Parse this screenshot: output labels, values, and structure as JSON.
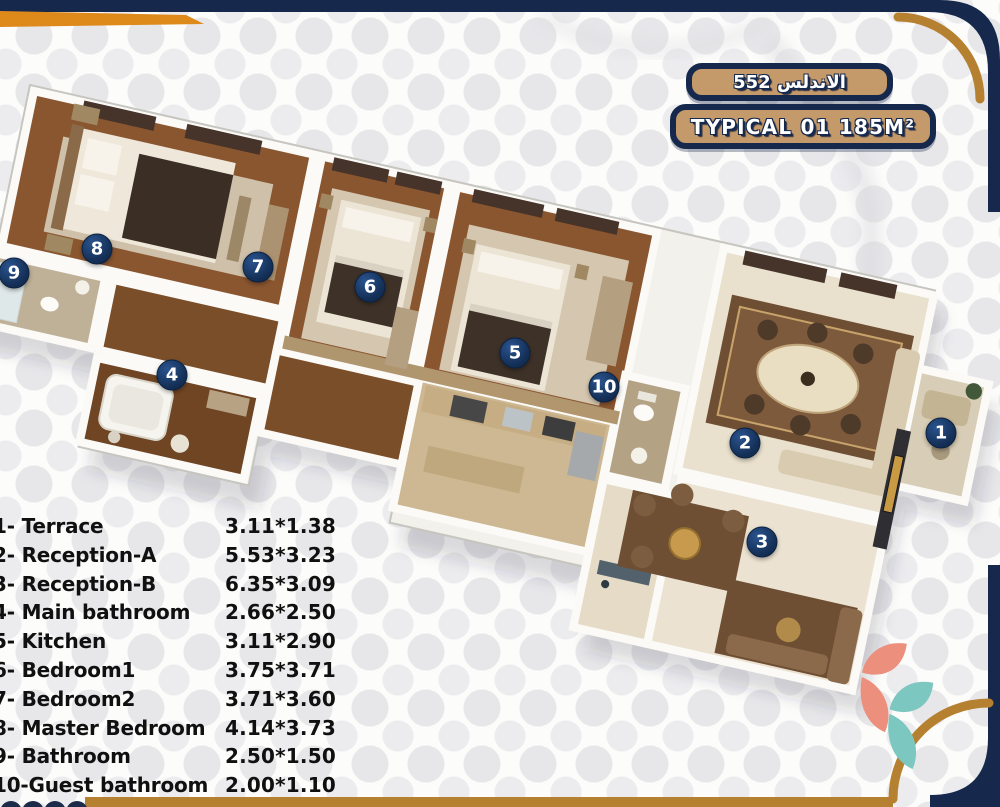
{
  "title_badges": {
    "project": "الاندلس 552",
    "unit_type": "TYPICAL 01 185M²"
  },
  "colors": {
    "navy": "#16294d",
    "gold": "#b5802f",
    "orange": "#dd8a1b",
    "badge_tan": "#c59a6b",
    "marker_navy": "#153159",
    "logo_coral": "#ec8f7d",
    "logo_teal": "#7cc7bf"
  },
  "legend": {
    "rows": [
      {
        "name": "1- Terrace",
        "dims": "3.11*1.38"
      },
      {
        "name": "2- Reception-A",
        "dims": "5.53*3.23"
      },
      {
        "name": "3- Reception-B",
        "dims": "6.35*3.09"
      },
      {
        "name": "4- Main bathroom",
        "dims": "2.66*2.50"
      },
      {
        "name": "5- Kitchen",
        "dims": "3.11*2.90"
      },
      {
        "name": "6- Bedroom1",
        "dims": "3.75*3.71"
      },
      {
        "name": "7- Bedroom2",
        "dims": "3.71*3.60"
      },
      {
        "name": "8- Master Bedroom",
        "dims": "4.14*3.73"
      },
      {
        "name": "9- Bathroom",
        "dims": "2.50*1.50"
      },
      {
        "name": "10-Guest bathroom",
        "dims": "2.00*1.10"
      }
    ]
  },
  "plan": {
    "markers": [
      {
        "n": "1",
        "room": "Terrace",
        "x": 941,
        "y": 433
      },
      {
        "n": "2",
        "room": "Reception-A",
        "x": 745,
        "y": 443
      },
      {
        "n": "3",
        "room": "Reception-B",
        "x": 762,
        "y": 542
      },
      {
        "n": "4",
        "room": "Main bathroom",
        "x": 172,
        "y": 375
      },
      {
        "n": "5",
        "room": "Kitchen",
        "x": 515,
        "y": 353
      },
      {
        "n": "6",
        "room": "Bedroom1",
        "x": 370,
        "y": 287
      },
      {
        "n": "7",
        "room": "Bedroom2",
        "x": 258,
        "y": 267
      },
      {
        "n": "8",
        "room": "Master Bedroom",
        "x": 97,
        "y": 249
      },
      {
        "n": "9",
        "room": "Bathroom",
        "x": 14,
        "y": 273
      },
      {
        "n": "10",
        "room": "Guest bathroom",
        "x": 604,
        "y": 387
      }
    ]
  }
}
